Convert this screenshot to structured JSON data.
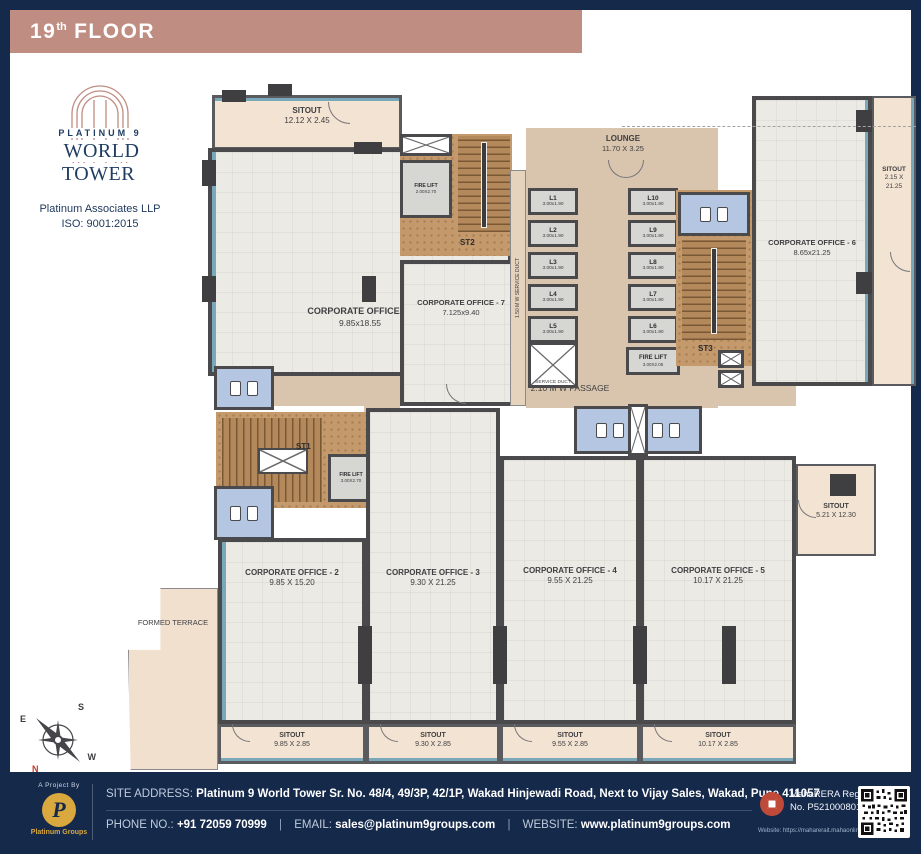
{
  "header": {
    "floor_number": "19",
    "floor_ordinal": "th",
    "floor_word": "FLOOR"
  },
  "brand": {
    "logo_top": "PLATINUM 9",
    "logo_main": "WORLD TOWER",
    "company": "Platinum Associates LLP",
    "iso": "ISO: 9001:2015"
  },
  "compass": {
    "north": "N",
    "south": "S",
    "east": "E",
    "west": "W"
  },
  "plan": {
    "sitout_top": {
      "name": "SITOUT",
      "dims": "12.12 X 2.45"
    },
    "office1": {
      "name": "CORPORATE OFFICE - 1",
      "dims": "9.85x18.55"
    },
    "office2": {
      "name": "CORPORATE OFFICE - 2",
      "dims": "9.85 X 15.20"
    },
    "office3": {
      "name": "CORPORATE OFFICE - 3",
      "dims": "9.30 X 21.25"
    },
    "office4": {
      "name": "CORPORATE OFFICE - 4",
      "dims": "9.55 X 21.25"
    },
    "office5": {
      "name": "CORPORATE OFFICE - 5",
      "dims": "10.17 X 21.25"
    },
    "office6": {
      "name": "CORPORATE OFFICE - 6",
      "dims": "8.65x21.25"
    },
    "office7": {
      "name": "CORPORATE OFFICE - 7",
      "dims": "7.125x9.40"
    },
    "sitout_office2": {
      "name": "SITOUT",
      "dims": "9.85 X 2.85"
    },
    "sitout_office3": {
      "name": "SITOUT",
      "dims": "9.30 X 2.85"
    },
    "sitout_office4": {
      "name": "SITOUT",
      "dims": "9.55 X 2.85"
    },
    "sitout_office5": {
      "name": "SITOUT",
      "dims": "10.17 X 2.85"
    },
    "sitout_right": {
      "name": "SITOUT",
      "dims": "2.15 X 21.25"
    },
    "sitout_side": {
      "name": "SITOUT",
      "dims": "5.21 X 12.30"
    },
    "lounge": {
      "name": "LOUNGE",
      "dims": "11.70 X 3.25"
    },
    "formed_terrace": "FORMED TERRACE",
    "passage_vertical": "2.10 M W PASSAGE",
    "passage_horizontal": "2.10 M W PASSAGE",
    "service_duct_vertical": "1.50 M W SERVICE DUCT",
    "service_duct": "SERVICE DUCT",
    "stair1": "ST1",
    "stair2": "ST2",
    "stair3": "ST3",
    "fire_lift_st2": {
      "name": "FIRE LIFT",
      "dims": "2.00X2.70"
    },
    "fire_lift_st1": {
      "name": "FIRE LIFT",
      "dims": "3.00X2.70"
    },
    "fire_lift_main": {
      "name": "FIRE LIFT",
      "dims": "3.00X2.05"
    },
    "lifts_left": [
      {
        "name": "L1",
        "dims": "3.00x1.90"
      },
      {
        "name": "L2",
        "dims": "3.00x1.90"
      },
      {
        "name": "L3",
        "dims": "3.00x1.90"
      },
      {
        "name": "L4",
        "dims": "3.00x1.90"
      },
      {
        "name": "L5",
        "dims": "3.00x1.90"
      }
    ],
    "lifts_right": [
      {
        "name": "L10",
        "dims": "3.00x1.90"
      },
      {
        "name": "L9",
        "dims": "3.00x1.90"
      },
      {
        "name": "L8",
        "dims": "3.00x1.90"
      },
      {
        "name": "L7",
        "dims": "3.00x1.90"
      },
      {
        "name": "L6",
        "dims": "3.00x1.90"
      }
    ]
  },
  "footer": {
    "project_by": "A Project By",
    "logo_letter": "P",
    "logo_name": "Platinum Groups",
    "site_address_label": "SITE ADDRESS:",
    "site_address_name": "Platinum 9 World Tower",
    "site_address_rest": "Sr. No. 48/4, 49/3P, 42/1P, Wakad Hinjewadi Road, Next to Vijay Sales, Wakad, Pune 411057",
    "phone_label": "PHONE NO.:",
    "phone": "+91 72059 70999",
    "separator": "|",
    "email_label": "EMAIL:",
    "email": "sales@platinum9groups.com",
    "website_label": "WEBSITE:",
    "website": "www.platinum9groups.com",
    "rera_title": "MahaRERA Registration",
    "rera_number": "No. P5210008017B",
    "rera_website": "Website: https://maharerait.mahaonline.gov.in"
  },
  "colors": {
    "navy": "#15294b",
    "header_mauve": "#c08d82",
    "gold": "#d9a83e",
    "sitout_beige": "#f3e3d2",
    "passage_tan": "#d9c4ad",
    "washroom_blue": "#b5c6e2",
    "stair_brown": "#b3885b",
    "wall_gray": "#4a4a4c",
    "window_teal": "#79a8bb",
    "rera_red": "#c04a3a"
  }
}
